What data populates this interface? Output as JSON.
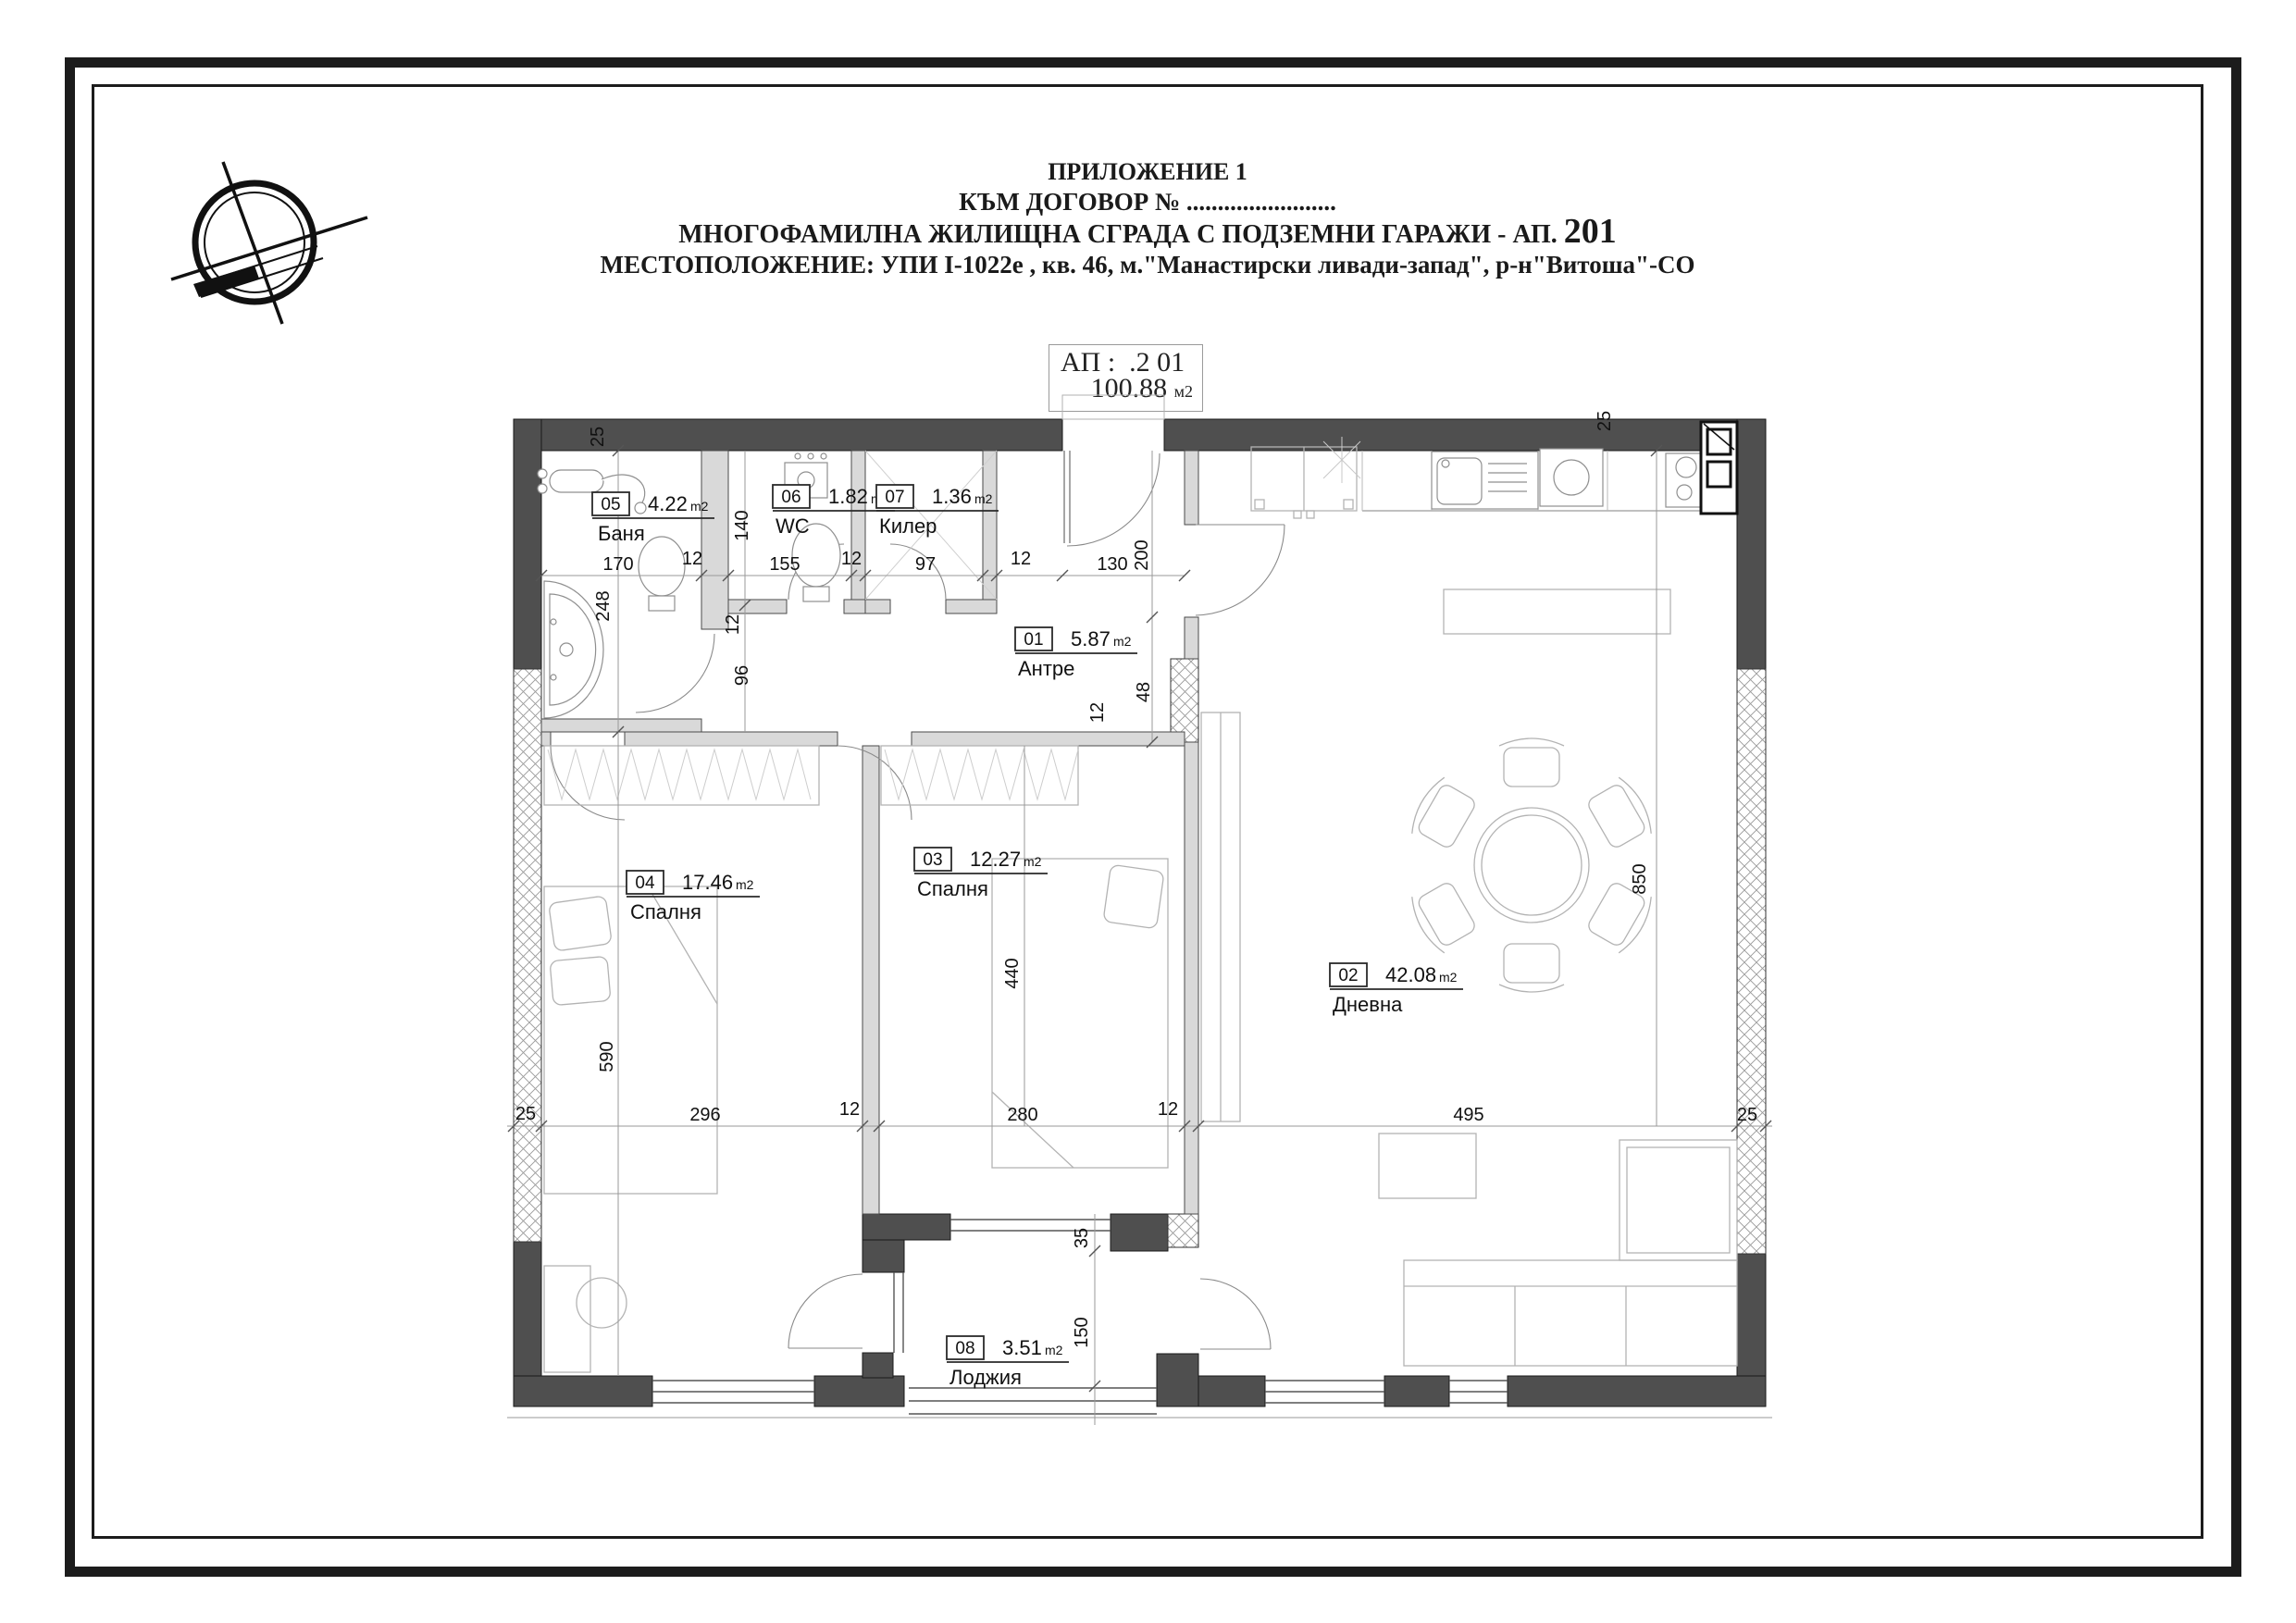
{
  "header": {
    "line1": "ПРИЛОЖЕНИЕ 1",
    "line2": "КЪМ ДОГОВОР № ........................",
    "line3_text": "МНОГОФАМИЛНА ЖИЛИЩНА СГРАДА С ПОДЗЕМНИ ГАРАЖИ - АП.",
    "line3_number": "201",
    "line4": "МЕСТОПОЛОЖЕНИЕ: УПИ I-1022е , кв. 46, м.\"Манастирски ливади-запад\", р-н\"Витоша\"-СО"
  },
  "apartment_box": {
    "label": "АП :",
    "number": ".2 01",
    "area_value": "100.88",
    "area_unit": "м2"
  },
  "rooms": {
    "r01": {
      "number": "01",
      "name": "Антре",
      "area": "5.87",
      "unit": "m2"
    },
    "r02": {
      "number": "02",
      "name": "Дневна",
      "area": "42.08",
      "unit": "m2"
    },
    "r03": {
      "number": "03",
      "name": "Спалня",
      "area": "12.27",
      "unit": "m2"
    },
    "r04": {
      "number": "04",
      "name": "Спалня",
      "area": "17.46",
      "unit": "m2"
    },
    "r05": {
      "number": "05",
      "name": "Баня",
      "area": "4.22",
      "unit": "m2"
    },
    "r06": {
      "number": "06",
      "name": "WC",
      "area": "1.82",
      "unit": "m2"
    },
    "r07": {
      "number": "07",
      "name": "Килер",
      "area": "1.36",
      "unit": "m2"
    },
    "r08": {
      "number": "08",
      "name": "Лоджия",
      "area": "3.51",
      "unit": "m2"
    }
  },
  "dims": {
    "t25_left": "25",
    "t25_right": "25",
    "h170": "170",
    "h12a": "12",
    "h155": "155",
    "h12b": "12",
    "h97": "97",
    "h12c": "12",
    "h130": "130",
    "v140": "140",
    "v200": "200",
    "v248": "248",
    "v12a": "12",
    "v96": "96",
    "v48": "48",
    "v12b": "12",
    "v590": "590",
    "v440": "440",
    "v850": "850",
    "v35": "35",
    "v150": "150",
    "b25_left": "25",
    "b296": "296",
    "b12a": "12",
    "b280": "280",
    "b12b": "12",
    "b495": "495",
    "b25_right": "25"
  },
  "colors": {
    "wall": "#4f4f4f",
    "partition": "#d9d9d9",
    "line": "#1c1c1c"
  }
}
